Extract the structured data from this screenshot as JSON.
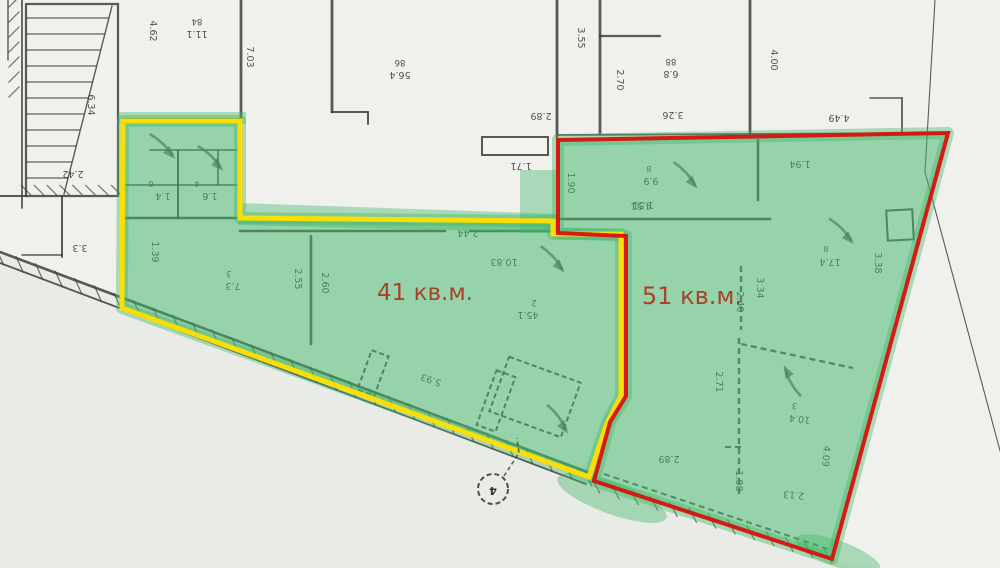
{
  "plan_title": "floor plan with two highlighted retail units",
  "colors": {
    "paper": "#f0f1ed",
    "paper_shade_below": "#e9ebe6",
    "line": "#3f3e3a",
    "text": "#403f3b",
    "green_fill": "rgba(62,182,104,0.50)",
    "green_bleed": "rgba(62,182,104,0.40)",
    "yellow_outline": "#ffdf00",
    "red_outline": "#d7150f",
    "area_text": "#a8422a",
    "rect_fill": "#f4f5f1"
  },
  "units": [
    {
      "id": "unit-41",
      "label": "41 кв.м.",
      "label_x": 425,
      "label_y": 300,
      "label_size": 23,
      "outline_color": "#ffdf00",
      "outline_width": 5,
      "points": "123,121 240,121 240,218 553,221 553,234 621,234 621,396 607,423 589,477 122,308"
    },
    {
      "id": "unit-51",
      "label": "51 кв.м.",
      "label_x": 692,
      "label_y": 304,
      "label_size": 24,
      "outline_color": "#d7150f",
      "outline_width": 4,
      "points": "558,140 948,133 832,559 594,481 610,422 626,396 626,236 558,233"
    }
  ],
  "green_extra_polys": [
    "238,203 560,214 560,233 238,225",
    "520,170 558,170 558,233 520,233",
    "118,112 246,112 246,124 118,124"
  ],
  "green_extra_ellipses": [
    {
      "cx": 612,
      "cy": 498,
      "rx": 58,
      "ry": 16,
      "rot": 20
    },
    {
      "cx": 838,
      "cy": 554,
      "rx": 45,
      "ry": 13,
      "rot": 20
    }
  ],
  "paper_shade_polygon": "0,252 590,473 832,559 876,568 0,568",
  "walls_solid": [
    {
      "p": "8,0 8,60",
      "w": 1.4
    },
    {
      "p": "22,0 22,208",
      "w": 1.8
    },
    {
      "p": "26,4 118,4 118,196 26,196 26,4",
      "w": 2.2
    },
    {
      "p": "112,6 64,194",
      "w": 1.4
    },
    {
      "p": "0,196 26,196",
      "w": 2
    },
    {
      "p": "62,196 62,257",
      "w": 2
    },
    {
      "p": "22,255 62,255",
      "w": 1.5
    },
    {
      "p": "241,0 241,121",
      "w": 2.8
    },
    {
      "p": "123,119 240,119",
      "w": 2
    },
    {
      "p": "123,218 240,218",
      "w": 2.4
    },
    {
      "p": "240,121 240,218",
      "w": 2
    },
    {
      "p": "150,150 238,150",
      "w": 1.6
    },
    {
      "p": "178,150 178,218",
      "w": 2
    },
    {
      "p": "123,185 240,185",
      "w": 1.6
    },
    {
      "p": "218,150 218,185",
      "w": 1.6
    },
    {
      "p": "332,0 332,112",
      "w": 2.8
    },
    {
      "p": "332,112 368,112",
      "w": 2
    },
    {
      "p": "368,112 368,124",
      "w": 2
    },
    {
      "p": "240,231 445,231",
      "w": 2.6
    },
    {
      "p": "470,231 557,231",
      "w": 2.6
    },
    {
      "p": "311,236 311,344",
      "w": 2.6
    },
    {
      "p": "557,0 557,137",
      "w": 2.8
    },
    {
      "p": "600,0 600,133",
      "w": 2.8
    },
    {
      "p": "600,36 660,36",
      "w": 2.2
    },
    {
      "p": "750,0 750,133",
      "w": 2.8
    },
    {
      "p": "557,135 946,133",
      "w": 1.8
    },
    {
      "p": "902,98 902,133",
      "w": 1.8
    },
    {
      "p": "870,98 902,98",
      "w": 1.4
    },
    {
      "p": "558,219 770,219",
      "w": 2.6
    },
    {
      "p": "758,140 758,200",
      "w": 2.6
    },
    {
      "p": "0,252 590,473",
      "w": 2.6
    },
    {
      "p": "0,263 586,484",
      "w": 1.8
    },
    {
      "p": "935,0 925,172",
      "w": 1.1
    },
    {
      "p": "925,172 1002,458",
      "w": 1.1
    }
  ],
  "walls_dashed": [
    {
      "p": "741,266 741,330",
      "w": 2.4
    },
    {
      "p": "739,338 739,497",
      "w": 2.4
    },
    {
      "p": "741,344 853,368",
      "w": 2.4
    },
    {
      "p": "725,447 741,447",
      "w": 2
    },
    {
      "p": "604,474 828,549",
      "w": 2
    }
  ],
  "stair_treads": [
    "26,18 109,18",
    "26,34 105,34",
    "26,50 101,50",
    "26,66 97,66",
    "26,82 93,82",
    "26,98 89,98",
    "26,114 84,114",
    "26,130 80,130",
    "26,146 76,146",
    "26,162 72,162",
    "26,178 68,178"
  ],
  "hatches": [
    {
      "x1": 0,
      "y1": 257,
      "x2": 588,
      "y2": 478,
      "n": 30,
      "len": 13
    },
    {
      "x1": 596,
      "y1": 486,
      "x2": 828,
      "y2": 556,
      "n": 12,
      "len": 12
    },
    {
      "x1": 14,
      "y1": 2,
      "x2": 14,
      "y2": 92,
      "n": 6,
      "len": 11
    },
    {
      "x1": 26,
      "y1": 190,
      "x2": 116,
      "y2": 190,
      "n": 7,
      "len": 10
    }
  ],
  "rects": [
    {
      "x": 482,
      "y": 137,
      "w": 66,
      "h": 18,
      "rot": 0,
      "fill": true,
      "dash": false
    },
    {
      "x": 887,
      "y": 210,
      "w": 26,
      "h": 30,
      "rot": -3,
      "fill": true,
      "dash": false
    },
    {
      "x": 364,
      "y": 352,
      "w": 18,
      "h": 42,
      "rot": 20,
      "fill": false,
      "dash": true
    },
    {
      "x": 486,
      "y": 372,
      "w": 20,
      "h": 58,
      "rot": 20,
      "fill": false,
      "dash": true
    },
    {
      "x": 497,
      "y": 368,
      "w": 76,
      "h": 58,
      "rot": 20,
      "fill": false,
      "dash": true
    }
  ],
  "arrows": [
    {
      "x": 163,
      "y": 147,
      "r": 8
    },
    {
      "x": 211,
      "y": 159,
      "r": 8
    },
    {
      "x": 553,
      "y": 260,
      "r": 12
    },
    {
      "x": 686,
      "y": 176,
      "r": 12
    },
    {
      "x": 558,
      "y": 420,
      "r": 18
    },
    {
      "x": 792,
      "y": 380,
      "r": 205
    },
    {
      "x": 842,
      "y": 232,
      "r": 10
    }
  ],
  "dimensions": [
    {
      "t": "6.34",
      "x": 88,
      "y": 105,
      "r": 90
    },
    {
      "t": "4.62",
      "x": 150,
      "y": 31,
      "r": 90
    },
    {
      "t": "84",
      "x": 197,
      "y": 19,
      "r": 180,
      "s": 8.5
    },
    {
      "t": "11.1",
      "x": 197,
      "y": 31,
      "r": 180
    },
    {
      "t": "2.42",
      "x": 73,
      "y": 171,
      "r": 180
    },
    {
      "t": "3.3",
      "x": 80,
      "y": 245,
      "r": 180
    },
    {
      "t": "7.03",
      "x": 247,
      "y": 57,
      "r": 90
    },
    {
      "t": "86",
      "x": 400,
      "y": 60,
      "r": 180,
      "s": 8.5
    },
    {
      "t": "56.4",
      "x": 400,
      "y": 72,
      "r": 180
    },
    {
      "t": "2.89",
      "x": 541,
      "y": 113,
      "r": 180
    },
    {
      "t": "1.71",
      "x": 521,
      "y": 163,
      "r": 180
    },
    {
      "t": "3.55",
      "x": 578,
      "y": 38,
      "r": 90
    },
    {
      "t": "2.70",
      "x": 617,
      "y": 80,
      "r": 90
    },
    {
      "t": "88",
      "x": 671,
      "y": 59,
      "r": 180,
      "s": 8.5
    },
    {
      "t": "6.8",
      "x": 671,
      "y": 71,
      "r": 180
    },
    {
      "t": "3.26",
      "x": 673,
      "y": 112,
      "r": 180
    },
    {
      "t": "4.00",
      "x": 771,
      "y": 60,
      "r": 90
    },
    {
      "t": "4.49",
      "x": 839,
      "y": 115,
      "r": 180
    },
    {
      "t": "1.94",
      "x": 800,
      "y": 161,
      "r": 180
    },
    {
      "t": "6",
      "x": 151,
      "y": 181,
      "r": 180,
      "s": 8
    },
    {
      "t": "1.4",
      "x": 163,
      "y": 193,
      "r": 180
    },
    {
      "t": "4",
      "x": 197,
      "y": 181,
      "r": 180,
      "s": 8
    },
    {
      "t": "1.6",
      "x": 210,
      "y": 193,
      "r": 180
    },
    {
      "t": "1.39",
      "x": 152,
      "y": 252,
      "r": 90
    },
    {
      "t": "3",
      "x": 229,
      "y": 271,
      "r": 180,
      "s": 8.5
    },
    {
      "t": "7.3",
      "x": 233,
      "y": 283,
      "r": 180
    },
    {
      "t": "2.55",
      "x": 295,
      "y": 279,
      "r": 90
    },
    {
      "t": "2.60",
      "x": 322,
      "y": 283,
      "r": 90
    },
    {
      "t": "2.44",
      "x": 468,
      "y": 230,
      "r": 180
    },
    {
      "t": "10.83",
      "x": 504,
      "y": 259,
      "r": 180
    },
    {
      "t": "2",
      "x": 534,
      "y": 300,
      "r": 180,
      "s": 8.5
    },
    {
      "t": "45.1",
      "x": 528,
      "y": 312,
      "r": 180
    },
    {
      "t": "5.93",
      "x": 432,
      "y": 377,
      "r": 200
    },
    {
      "t": "1.90",
      "x": 568,
      "y": 183,
      "r": 90
    },
    {
      "t": "1.51",
      "x": 643,
      "y": 202,
      "r": 180
    },
    {
      "t": "8",
      "x": 649,
      "y": 166,
      "r": 180,
      "s": 8
    },
    {
      "t": "9.9",
      "x": 651,
      "y": 178,
      "r": 180
    },
    {
      "t": "4.51",
      "x": 641,
      "y": 203,
      "r": 180
    },
    {
      "t": "8",
      "x": 826,
      "y": 246,
      "r": 180,
      "s": 8
    },
    {
      "t": "17.4",
      "x": 830,
      "y": 259,
      "r": 180
    },
    {
      "t": "3.38",
      "x": 875,
      "y": 263,
      "r": 90
    },
    {
      "t": "3.34",
      "x": 757,
      "y": 288,
      "r": 90
    },
    {
      "t": "2.40",
      "x": 737,
      "y": 302,
      "r": 90
    },
    {
      "t": "2.71",
      "x": 716,
      "y": 382,
      "r": 90
    },
    {
      "t": "2.89",
      "x": 669,
      "y": 456,
      "r": 180
    },
    {
      "t": "1.98",
      "x": 736,
      "y": 481,
      "r": 90
    },
    {
      "t": "3",
      "x": 795,
      "y": 403,
      "r": 187,
      "s": 8.5
    },
    {
      "t": "10.4",
      "x": 800,
      "y": 416,
      "r": 187
    },
    {
      "t": "4.09",
      "x": 823,
      "y": 456,
      "r": 95
    },
    {
      "t": "2.13",
      "x": 794,
      "y": 492,
      "r": 185
    }
  ],
  "marker": {
    "label": "4",
    "x": 493,
    "y": 489,
    "r": 15,
    "leader": "504,476 519,453 517,438"
  }
}
